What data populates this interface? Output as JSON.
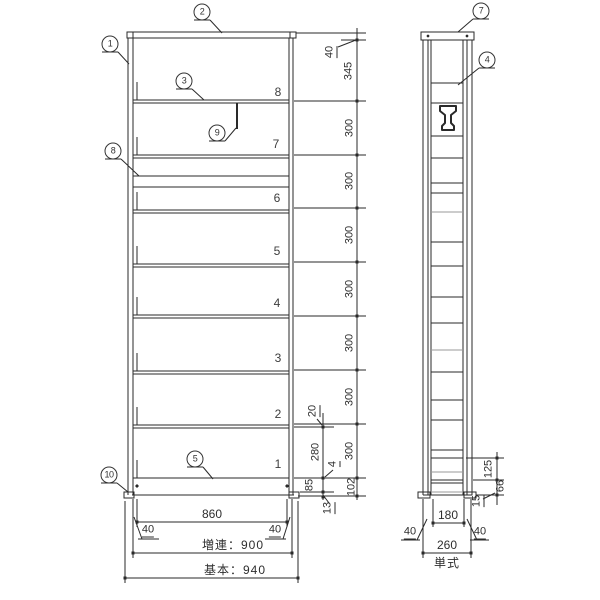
{
  "shelf_numbers": [
    "8",
    "7",
    "6",
    "5",
    "4",
    "3",
    "2",
    "1"
  ],
  "balloons": {
    "b1": "1",
    "b2": "2",
    "b3": "3",
    "b4": "4",
    "b5": "5",
    "b7": "7",
    "b8": "8",
    "b9": "9",
    "b10": "10"
  },
  "dims": {
    "cap_height": "40",
    "top_segment": "345",
    "shelf_pitch": "300",
    "base_height": "102",
    "d20": "20",
    "d280": "280",
    "d4": "4",
    "d85": "85",
    "d13": "13",
    "front_inner_width": "860",
    "front_40_left": "40",
    "front_40_right": "40",
    "front_width_extension": "増連：900",
    "front_width_basic": "基本：940",
    "side_125": "125",
    "side_66": "66",
    "side_15": "15",
    "side_inner_width": "180",
    "side_40_left": "40",
    "side_40_right": "40",
    "side_depth": "260",
    "side_type": "単式"
  },
  "colors": {
    "line": "#2a2a2a",
    "light_line": "#9a9a9a",
    "background": "#ffffff"
  }
}
